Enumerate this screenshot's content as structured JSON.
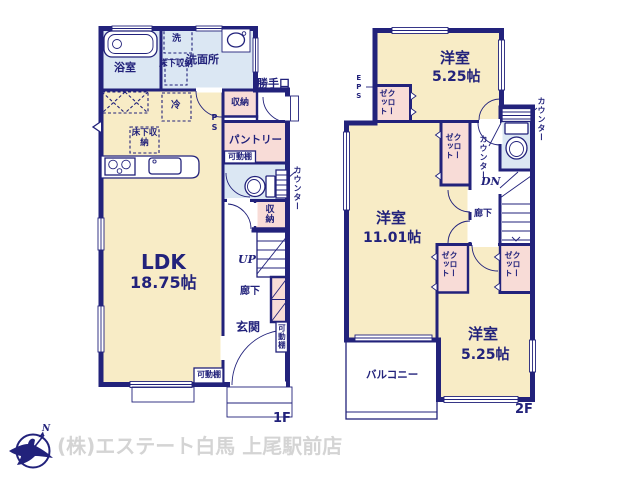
{
  "floor1": {
    "floor_label": "1F",
    "bath": "浴室",
    "washer": "洗",
    "washroom": "洗面所",
    "underfloor_storage_a": "床下収納",
    "underfloor_storage_b": "床下収納",
    "fridge": "冷",
    "back_door": "勝手口",
    "storage_a": "収納",
    "pipe_space": "PS",
    "pantry": "パントリー",
    "movable_shelf_a": "可動棚",
    "counter": "カウンター",
    "storage_b": "収納",
    "up": "UP",
    "hallway": "廊下",
    "entrance": "玄関",
    "movable_shelf_b": "可動棚",
    "movable_shelf_c": "可動棚",
    "ldk_name": "LDK",
    "ldk_size": "18.75帖"
  },
  "floor2": {
    "floor_label": "2F",
    "eps": "EPS",
    "room_top_name": "洋室",
    "room_top_size": "5.25帖",
    "closet_top": "クローゼット",
    "counter_right": "カウンター",
    "counter_left": "カウンター",
    "dn": "DN",
    "room_mid_name": "洋室",
    "room_mid_size": "11.01帖",
    "closet_mid_upper": "クローゼット",
    "closet_mid_lower": "クローゼット",
    "closet_right": "クローゼット",
    "hallway": "廊下",
    "room_bottom_name": "洋室",
    "room_bottom_size": "5.25帖",
    "balcony": "バルコニー"
  },
  "footer": {
    "north_label": "N",
    "company": "(株)エステート白馬 上尾駅前店"
  },
  "colors": {
    "wall": "#22227b",
    "room": "#f8ecc6",
    "wet": "#dbe7f3",
    "closet": "#f8dcd7",
    "company_text": "#d4d4d4"
  }
}
